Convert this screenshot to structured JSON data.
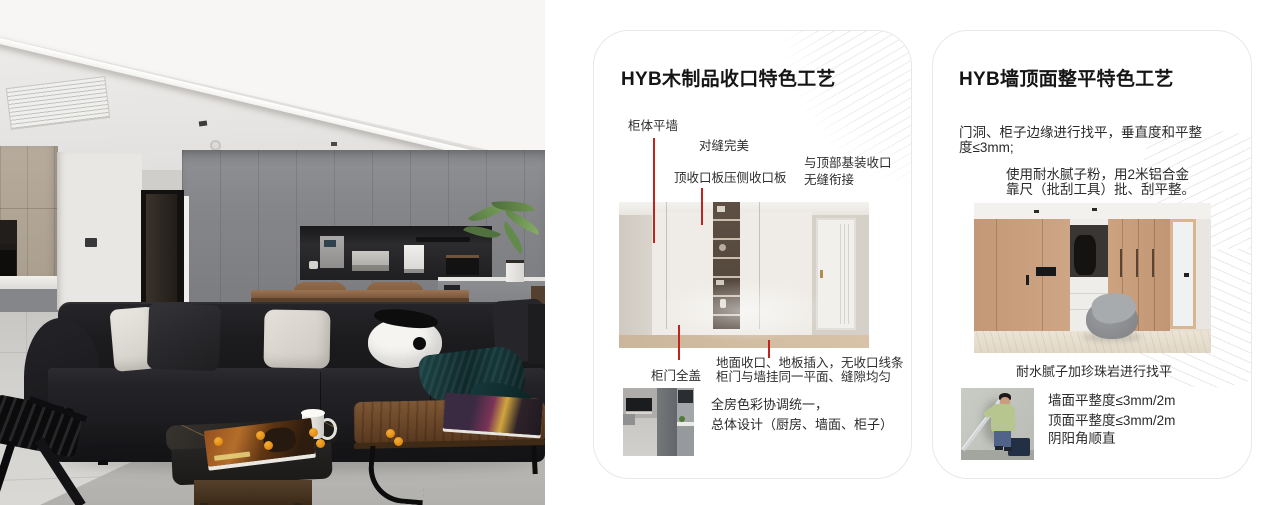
{
  "colors": {
    "accent_red": "#c1241d",
    "card_border": "#e8e8e8",
    "page_bg": "#ffffff"
  },
  "hero": {
    "description": "modern living room with black leather sofa, panda cushion, walnut coffee tables and grey cabinet wall"
  },
  "card1": {
    "title": "HYB木制品收口特色工艺",
    "callout_cabinet_wall": "柜体平墙",
    "callout_seam": "对缝完美",
    "callout_top_panel": "顶收口板压侧收口板",
    "callout_ceiling_line1": "与顶部基装收口",
    "callout_ceiling_line2": "无缝衔接",
    "callout_door": "柜门全盖",
    "callout_floor_line1": "地面收口、地板插入，无收口线条",
    "callout_floor_line2": "柜门与墙挂同一平面、缝隙均匀",
    "summary_line1": "全房色彩协调统一，",
    "summary_line2": "总体设计（厨房、墙面、柜子）"
  },
  "card2": {
    "title": "HYB墙顶面整平特色工艺",
    "para1_line1": "门洞、柜子边缘进行找平，垂直度和平整",
    "para1_line2": "度≤3mm;",
    "para2_line1": "使用耐水腻子粉，用2米铝合金",
    "para2_line2": "靠尺（批刮工具）批、刮平整。",
    "caption": "耐水腻子加珍珠岩进行找平",
    "bullets": [
      "墙面平整度≤3mm/2m",
      "顶面平整度≤3mm/2m",
      "阴阳角顺直"
    ]
  }
}
